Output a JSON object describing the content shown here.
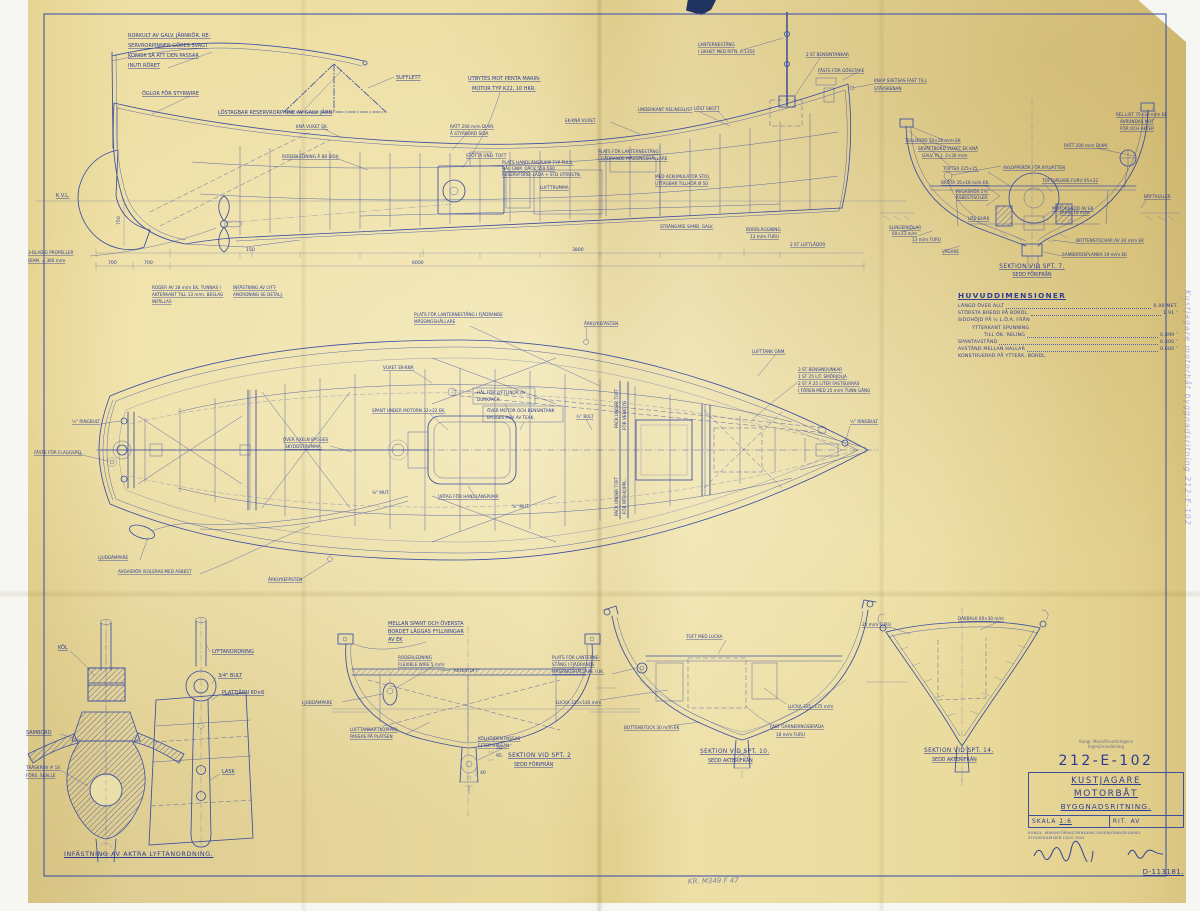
{
  "colors": {
    "ink": "#2e3f95",
    "paper": "#e9daa0",
    "frame": "#4456a5"
  },
  "prof": {
    "rk1": "RORKULT AV GALV. JÄRNRÖR. RE-",
    "rk2": "SERVRORPINNEN GÖRES SVAGT",
    "rk3": "KONISK SÅ ATT DEN PASSAR",
    "rk4": "INUTI RÖRET",
    "oglor": "ÖGLOR FÖR STYRWIRE",
    "reservpinne": "LÖSTAGBAR RESERVRORPINNE AV GALV. JÄRN",
    "sufflett": "SUFFLETT",
    "penta1": "UTBYTES MOT PENTA MARIN-",
    "penta2": "MOTOR TYP K22, 10 HKR.",
    "ratt1": "RATT 200 m/m DIAM.",
    "ratt2": "Å STYRBORD SIDA",
    "kna": "KNÄ VUXET EK.",
    "ekkna": "EK-KNÄ VUXET",
    "ukrel": "UNDERKANT RELINGSLIST",
    "roderledning": "RODERLEDNING Å BB SIDA",
    "lantern1": "LANTERNESTÅNG",
    "lantern2": "I LIKHET MED RITN. A-1354",
    "tankar": "2 ST BENSINTANKAR",
    "gosstake": "FÄSTE FÖR GÖSSTAKE",
    "knap1": "KNAP SVETSAS FAST TILL",
    "knap2": "STÄVSKENAN",
    "lostskott": "LÖST SKOTT",
    "kvl": "K.V.L.",
    "prop1": "3-BLADIG PROPELLER",
    "prop2": "DIAM. = 360 m/m",
    "stotta": "STÖTTA UND. TOFT",
    "pump1": "PLATS HANDLÄNSPUMP TYP PULS.",
    "pump2": "HÅL GNM. DÄCK 550-560",
    "pump3": "RESERVFÖRB. LÅDA + STD UTRUSTN.",
    "lufttrumma": "LUFTTRUMMA",
    "plant1": "PLATS FÖR LANTERNESTÅNG",
    "plant2": "I FJÄDRANDE MÄSSINGSHÅLLARE",
    "ack1": "MED ACKUMULATOR STOL",
    "ack2": "UTTAGBAR TILLHÖR Ø 50",
    "strangare": "STRÄNGARE SAMB. GALV.",
    "bordl1": "BORDLÄGGNING",
    "bordl2": "13 m/m FURU",
    "luftlador": "2 ST LUFTLÅDOR",
    "roder1": "RODER AV 28 m/m EK, TUNNAS I",
    "roder2": "AKTERKANT TILL 13 m/m. BESLAG",
    "roder3": "INFÄLLAS",
    "lyft1": "INFÄSTNING AV LYFT-",
    "lyft2": "ANORDNING SE DETALJ.",
    "d700a": "700",
    "d700b": "700",
    "d150": "150",
    "d3800": "3800",
    "d6000": "6000",
    "d750": "750"
  },
  "s7": {
    "tullbord": "TULLBORD 50×16 m/m EK",
    "skalm": "SKVÄTTBORD VUXET EK KNÄ",
    "galvplj": "GALV. PL.J. 3×30 m/m",
    "tofter": "TOFTER 225×25.",
    "brota": "BRÖTA 35×16 m/m EK.",
    "avlopp": "AVLOPPSRÖR FÖR KYLVATTEN",
    "avgas1": "AVGASRÖR 1¼\"",
    "avgas2": "ASBESTISOLER.",
    "ratt": "RATT 200 m/m DIAM.",
    "rellist1": "REL.LIST 70×30 m/m EK",
    "rellist2": "AVRUNDAS MOT",
    "rellist3": "FÖR OCH AKTER",
    "toftvagare": "TOFTVÄGARE FURU 95×22",
    "motorbadd": "MOTORBÄDD AV EK",
    "losdurk": "LÖS DURK",
    "durk": "DURK 18 m/m",
    "slinger1": "SLINGERKÖLAR",
    "slinger2": "60×23 m/m",
    "furu13": "13 m/m FURU",
    "bottenstockar": "BOTTENSTOCKAR AV 30 m/m EK",
    "vagare": "VÄGARE",
    "sambordplanka": "SAMBORDSPLANKA 19 m/m EK",
    "brytvulle": "BRYTVULLER",
    "cap": "SEKTION VID SPT. 7.",
    "capsub": "SEDD FÖRIFRÅN"
  },
  "pl": {
    "lantern1": "PLATS FÖR LANTERNESTÅNG I FJÄDRANDE",
    "lantern2": "MÄSSINGSHÅLLARE",
    "arklyke_top": "ÅRKLYKEFÄSTEN",
    "arklyke_bot": "ÅRKLYKEFÄSTEN",
    "lufttank": "LUFTTANK GNM.",
    "vuxet": "VUXET EK-KNÄ",
    "dunk1": "3 ST BENSINDUNKAR",
    "dunk2": "1 ST 25 LIT. SMÖRJOLJA",
    "dunk3": "2 ST Å 25 LITER FASTSURRAS",
    "dunk4": "I FÖREN MED 25 m/m TUNN GÅNG",
    "hal1": "HÅL FÖR LYFTLINOR AV",
    "hal2": "DURKPACK.",
    "huv1": "ÖVER MOTOR OCH BENSINTANK",
    "huv2": "BYGGES HUV AV TEAK.",
    "spant": "SPANT UNDER MOTORN 32×22 EK.",
    "bult34": "¾\" BULT",
    "axeln1": "ÖVER AXELN BYGGES",
    "axeln2": "SKYDDSTRUMMA.",
    "ringbult_l": "½\" RINGBULT",
    "ringbult_r": "½\" RINGBULT",
    "flaggspel": "FÄSTE FÖR FLAGGSPEL",
    "ljuddampare": "LJUDDÄMPARE",
    "avgasror": "AVGASRÖR ISOLERAS MED ASBEST",
    "urtag": "URTAG FÖR HANDLÄNSPUMP.",
    "mut_a": "⅝\" MUT.",
    "mut_b": "⅝\" MUT.",
    "pack1": "PACK UNDER TOFT",
    "pack2": "FÖR VERKTYG",
    "pack3": "PACK UNDER TOFT",
    "pack4": "FÖR MTR-KOPPL."
  },
  "s2": {
    "fyll1": "MELLAN SPANT OCH ÖVERSTA",
    "fyll2": "BORDET LÄGGAS FYLLNINGAR",
    "fyll3": "AV EK",
    "rodl1": "RODERLEDNING",
    "rodl2": "FLEXIBLE WIRE 5 m/m",
    "aktertoft": "\"AKTERTOFT\"",
    "ljudd": "LJUDDÄMPARE",
    "luft1": "LUFTTANKAR (KOPPAR)",
    "luft2": "PASSAS PÅ PLATSEN",
    "kol1": "KÖLHÖJDEN PASSAS",
    "kol2": "EFTER HYLSAN",
    "d50": "50.",
    "d95": "95.",
    "d40": "40",
    "cap": "SEKTION VID SPT. 2",
    "capsub": "SEDD FÖRIFRÅN"
  },
  "s10": {
    "toftlucka": "TOFT MED LUCKA",
    "pl1": "PLATS FÖR LANTERNE-",
    "pl2": "STÅNG I FJÄDRANDE",
    "pl3": "MÄSSINGSHÅLLARE I UK.",
    "lucka_l": "LUCKA 325×140 m/m",
    "lucka_r": "LUCKA 325×175 m/m",
    "garn1": "FAST GARNERINGSBRÄDA",
    "garn2": "18 m/m FURU",
    "bottenstock": "BOTTENSTOCK 30 m/m EK",
    "cap": "SEKTION VID SPT. 10.",
    "capsub": "SEDD AKTERIFRÅN"
  },
  "s14": {
    "furu20": "20 m/m FURU",
    "dackbalk": "DÄKBALK 60×30 m/m",
    "cap": "SEKTION VID SPT. 14.",
    "capsub": "SEDD AKTERIFRÅN"
  },
  "kd": {
    "kol": "KÖL",
    "sambord": "SAMBORD",
    "traskruv1": "TRÄSKRUV # 14",
    "traskruv2": "FÖRS. SKALLE",
    "lyftanordning": "LYFTANORDNING",
    "bult": "3/4\" BULT",
    "plattjarn": "PLATTJÄRN 60×6",
    "lask": "LASK",
    "caption": "INFÄSTNING AV AKTRA LYFTANORDNING."
  },
  "hd": {
    "title": "HUVUDDIMENSIONER",
    "rows": [
      {
        "label": "LÄNGD ÖVER ALLT",
        "value": "6.00 MET."
      },
      {
        "label": "STÖRSTA BREDD PÅ BORDL.",
        "value": "1.91  ″"
      },
      {
        "label": "SIDOHÖJD PÅ ½ L.Ö.A. FRÅN",
        "value": ""
      },
      {
        "label": "YTTERKANT SPUNNING",
        "value": ""
      },
      {
        "label": "TILL ÖK. RELING",
        "value": "0.899  ″"
      },
      {
        "label": "SPANTAVSTÅND",
        "value": "0.300  ″"
      },
      {
        "label": "AVSTÅND MELLAN HALLAR",
        "value": "0.600  ″"
      },
      {
        "label": "KONSTRUERAD PÅ YTTERK. BORDL.",
        "value": ""
      }
    ]
  },
  "tb": {
    "stamp1": "Kungl. Marinförvaltningens",
    "stamp2": "Ingenjöravdelning",
    "number": "212-E-102",
    "line1": "KUSTJAGARE",
    "line2": "MOTORBÅT",
    "line3": "BYGGNADSRITNING.",
    "scale_label": "SKALA",
    "scale_value": "1:6",
    "rit_label": "RIT. AV",
    "org": "KUNGL. MARINFÖRVALTNINGENS INGENJÖRAVDELNING",
    "place_date": "STOCKHOLM DEN 13/10 1941",
    "file_number": "D-113181."
  },
  "notes": {
    "pencil": "KR. M349 F 47",
    "margin_note": "Kustjagare motorbåt byggnadsritning 212-E-102"
  }
}
